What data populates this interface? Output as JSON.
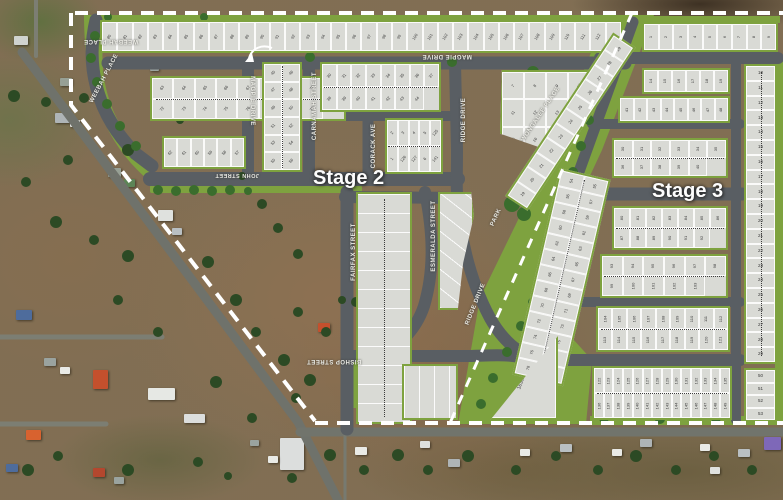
{
  "scene": {
    "type": "aerial-subdivision-masterplan",
    "stage2_label": "Stage 2",
    "stage3_label": "Stage 3",
    "park_label": "PARK"
  },
  "streets": [
    "WEEBAH PLACE",
    "WEEBAH PLACE",
    "MAGPIE DRIVE",
    "CARNAMAH STREET",
    "JOHN STREET",
    "MAGPIE DRIVE",
    "CORACK AVE",
    "RIDGE DRIVE",
    "WONGALEE PLACE",
    "RIDGE DRIVE",
    "FAIRFAX STREET",
    "ESMERALDA STREET",
    "BISHOP STREET"
  ],
  "icons": {
    "curved_arrow": "curved-arrow"
  },
  "lot_blocks": [
    {
      "id": "north-row",
      "stage": "2",
      "lots_from": 80,
      "lots_to": 113
    },
    {
      "id": "weebah-inner",
      "stage": "2",
      "lots_from": 63,
      "lots_to": 79
    },
    {
      "id": "weebah-south",
      "stage": "2",
      "lots": [
        62,
        61,
        60,
        59,
        58,
        57
      ]
    },
    {
      "id": "carnamah-west",
      "stage": "2",
      "lots_from": 45,
      "lots_to": 56
    },
    {
      "id": "carnamah-east",
      "stage": "2",
      "lots_from": 30,
      "lots_to": 44
    },
    {
      "id": "corack-east",
      "stage": "2",
      "lots": [
        2,
        3,
        4,
        5,
        125,
        1,
        126,
        127,
        6,
        141
      ]
    },
    {
      "id": "wongalee-triangle",
      "stage": "2",
      "lots_from": 7,
      "lots_to": 18
    },
    {
      "id": "wongalee-strip",
      "stage": "2",
      "lots_from": 19,
      "lots_to": 29
    },
    {
      "id": "s3-north-row",
      "stage": "3",
      "lots_from": 1,
      "lots_to": 9,
      "area_typical": "792m²"
    },
    {
      "id": "s3-row-a",
      "stage": "3",
      "lots_from": 14,
      "lots_to": 19,
      "area_typical": "758m²"
    },
    {
      "id": "s3-row-b",
      "stage": "3",
      "lots_from": 41,
      "lots_to": 48,
      "area_typical": "778m²"
    },
    {
      "id": "s3-block-30-40",
      "stage": "3",
      "lots_from": 30,
      "lots_to": 40,
      "area_typical": "750m²"
    },
    {
      "id": "s3-east-col",
      "stage": "3",
      "lots_from": 10,
      "lots_to": 29,
      "area_typical": "750m²"
    },
    {
      "id": "s3-east-col-lower",
      "stage": "3",
      "lots_from": 50,
      "lots_to": 53,
      "area_typical": "810m²"
    },
    {
      "id": "s3-west-band",
      "stage": "3",
      "lots_from": 54,
      "lots_to": 79,
      "area_typical": "750m²"
    },
    {
      "id": "s3-mid-upper",
      "stage": "3",
      "lots_from": 80,
      "lots_to": 92,
      "area_typical": "750m²"
    },
    {
      "id": "s3-mid-lower",
      "stage": "3",
      "lots_from": 93,
      "lots_to": 103,
      "area_typical": "750m²"
    },
    {
      "id": "s3-south-upper",
      "stage": "3",
      "lots_from": 104,
      "lots_to": 121,
      "area_typical": "750m²"
    },
    {
      "id": "s3-south-lower",
      "stage": "3",
      "lots_from": 122,
      "lots_to": 149,
      "area_typical": "750m²"
    },
    {
      "id": "s3-lot-206",
      "stage": "3",
      "lots": [
        206
      ],
      "area_typical": "1638m²"
    },
    {
      "id": "fairfax-esmeralda",
      "stage": "2",
      "lots": []
    },
    {
      "id": "esmeralda-east",
      "stage": "2",
      "lots": []
    },
    {
      "id": "bishop-east",
      "stage": "2",
      "lots": []
    }
  ],
  "areas_noted": [
    "750m²",
    "758m²",
    "778m²",
    "792m²",
    "810m²",
    "889m²",
    "908m²",
    "960m²",
    "1638m²"
  ],
  "colors": {
    "boundary_dash": "#ffffff",
    "plan_road": "#595e63",
    "lot_fill": "#d9dad5",
    "verge_green": "#7ea23f",
    "tree_green": "#2f5b28",
    "aerial_soil": "#83705a",
    "label_text": "#ecece6"
  }
}
